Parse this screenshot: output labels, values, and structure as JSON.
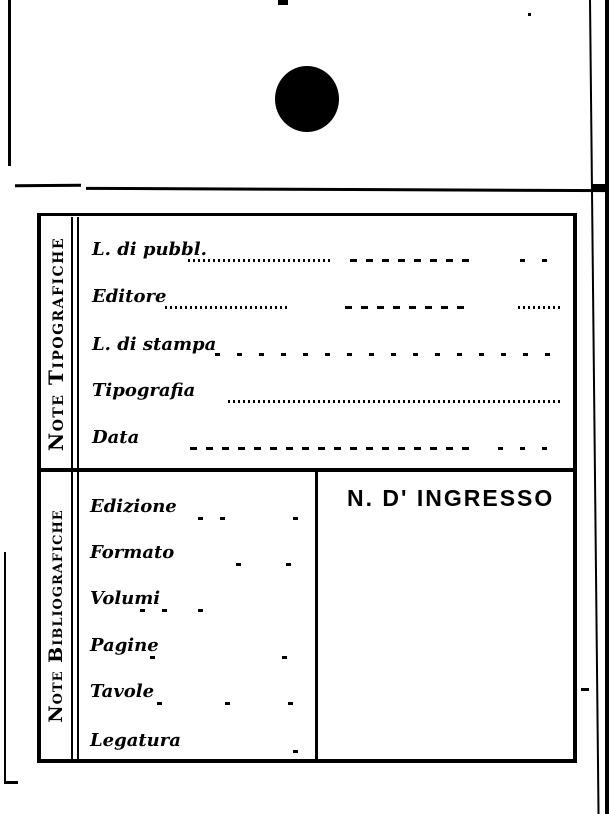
{
  "page": {
    "background": "#ffffff",
    "ink_color": "#000000"
  },
  "card": {
    "sections": [
      {
        "side_label": "Note Tipografiche",
        "fields": [
          {
            "label": "L. di pubbl."
          },
          {
            "label": "Editore"
          },
          {
            "label": "L. di stampa"
          },
          {
            "label": "Tipografia"
          },
          {
            "label": "Data"
          }
        ]
      },
      {
        "side_label": "Note Bibliografiche",
        "fields": [
          {
            "label": "Edizione"
          },
          {
            "label": "Formato"
          },
          {
            "label": "Volumi"
          },
          {
            "label": "Pagine"
          },
          {
            "label": "Tavole"
          },
          {
            "label": "Legatura"
          }
        ],
        "ingresso_header": "N. D' INGRESSO"
      }
    ]
  }
}
